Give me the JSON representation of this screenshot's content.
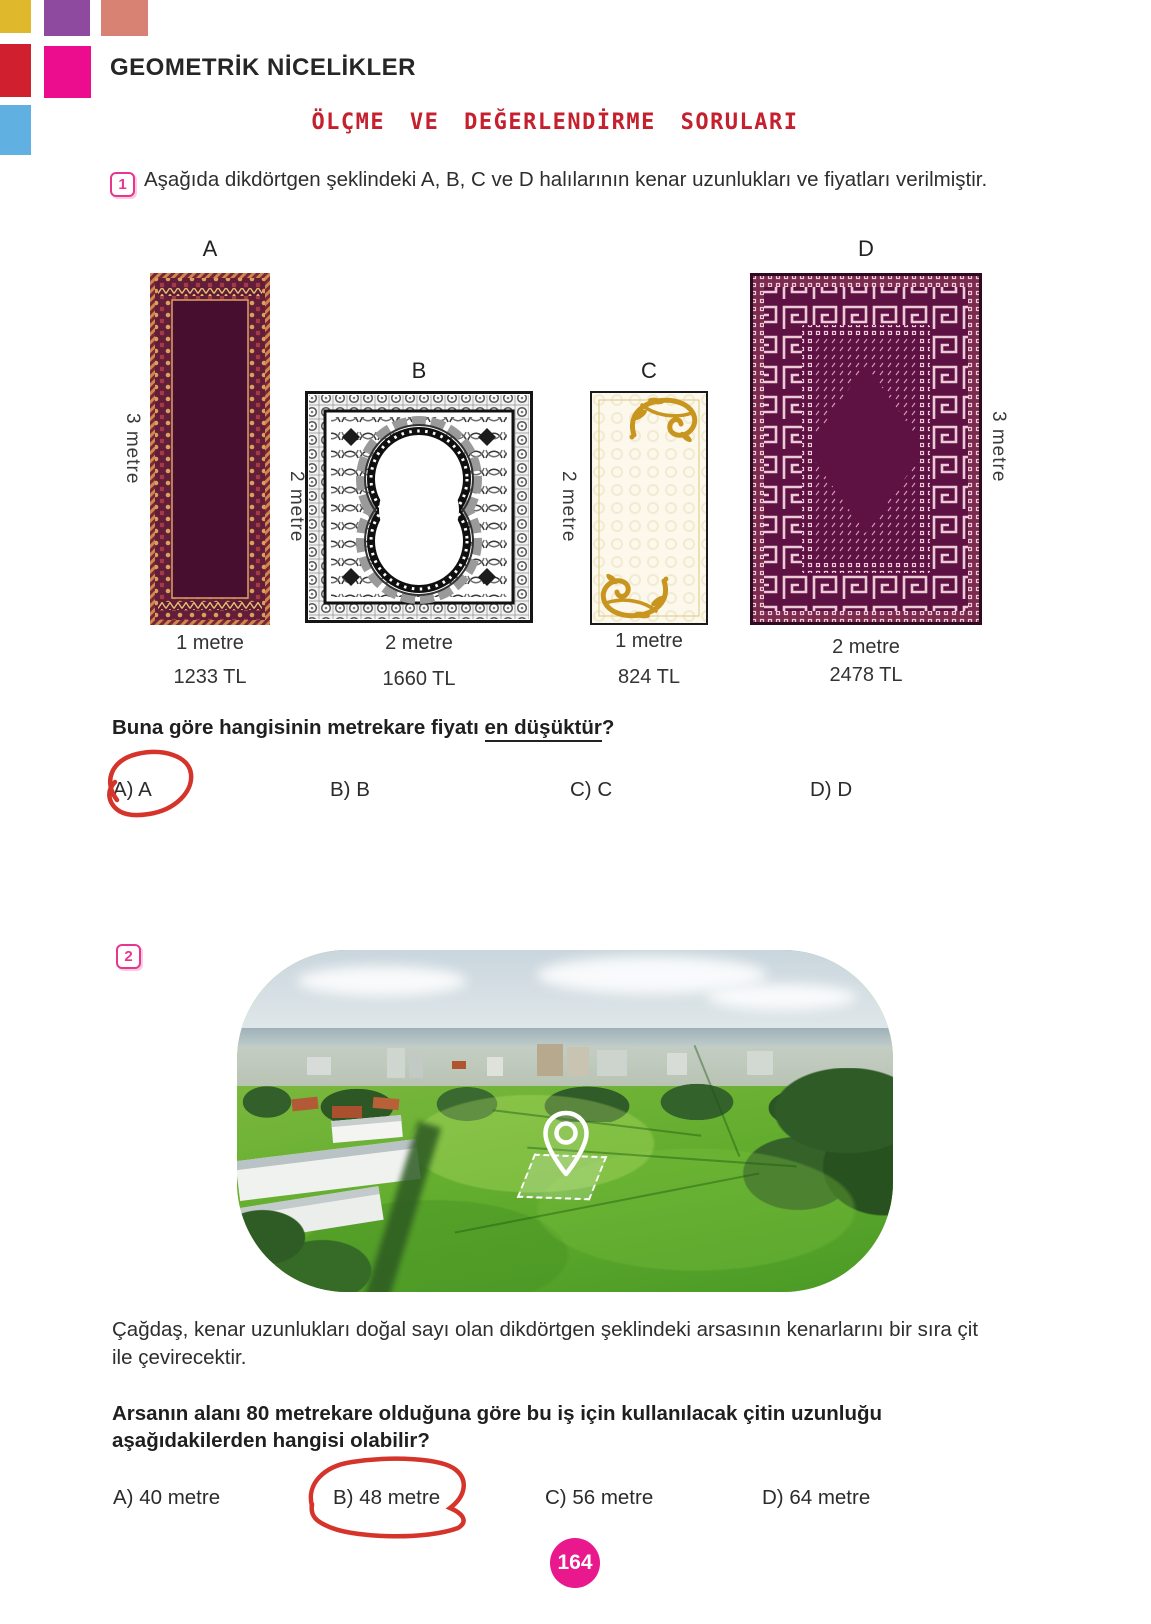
{
  "header": {
    "unit_title": "GEOMETRİK NİCELİKLER",
    "section_title": "ÖLÇME VE DEĞERLENDİRME SORULARI"
  },
  "question1": {
    "number": "1",
    "intro": "Aşağıda dikdörtgen şeklindeki A, B, C ve D halılarının kenar uzunlukları ve fiyatları verilmiştir.",
    "carpets": [
      {
        "id": "A",
        "height_label": "3 metre",
        "width_label": "1 metre",
        "price": "1233 TL"
      },
      {
        "id": "B",
        "height_label": "2 metre",
        "width_label": "2 metre",
        "price": "1660 TL"
      },
      {
        "id": "C",
        "height_label": "2 metre",
        "width_label": "1 metre",
        "price": "824 TL"
      },
      {
        "id": "D",
        "height_label": "3 metre",
        "width_label": "2 metre",
        "price": "2478 TL"
      }
    ],
    "prompt": {
      "prefix": "Buna göre hangisinin metrekare fiyatı ",
      "underlined": "en düşüktür",
      "suffix": "?"
    },
    "options": [
      {
        "label": "A) A",
        "circled": true
      },
      {
        "label": "B) B",
        "circled": false
      },
      {
        "label": "C) C",
        "circled": false
      },
      {
        "label": "D) D",
        "circled": false
      }
    ]
  },
  "question2": {
    "number": "2",
    "photo": {
      "icon": "location-pin-icon"
    },
    "passage": "Çağdaş, kenar uzunlukları doğal sayı olan dikdörtgen şeklindeki arsasının kenarlarını bir sıra çit ile çevirecektir.",
    "prompt": "Arsanın alanı 80 metrekare olduğuna göre bu iş için kullanılacak çitin uzunluğu aşağıdakilerden hangisi olabilir?",
    "options": [
      {
        "label": "A) 40 metre",
        "circled": false
      },
      {
        "label": "B) 48 metre",
        "circled": true
      },
      {
        "label": "C) 56 metre",
        "circled": false
      },
      {
        "label": "D) 64 metre",
        "circled": false
      }
    ]
  },
  "page_number": "164",
  "colors": {
    "accent_pink": "#eb0d8e",
    "section_title_red": "#c5202e",
    "annotation_red": "#d5342b",
    "carpet_a_field": "#480e30",
    "carpet_a_accent": "#d89a5e",
    "carpet_d_field": "#5e1243",
    "carpet_d_accent": "#eccbd6",
    "carpet_c_gold": "#c8961f",
    "corner_squares": [
      "#dfb92b",
      "#8d4a9e",
      "#d88273",
      "#d01f2f",
      "#eb0d8e",
      "#60b0e2"
    ]
  }
}
